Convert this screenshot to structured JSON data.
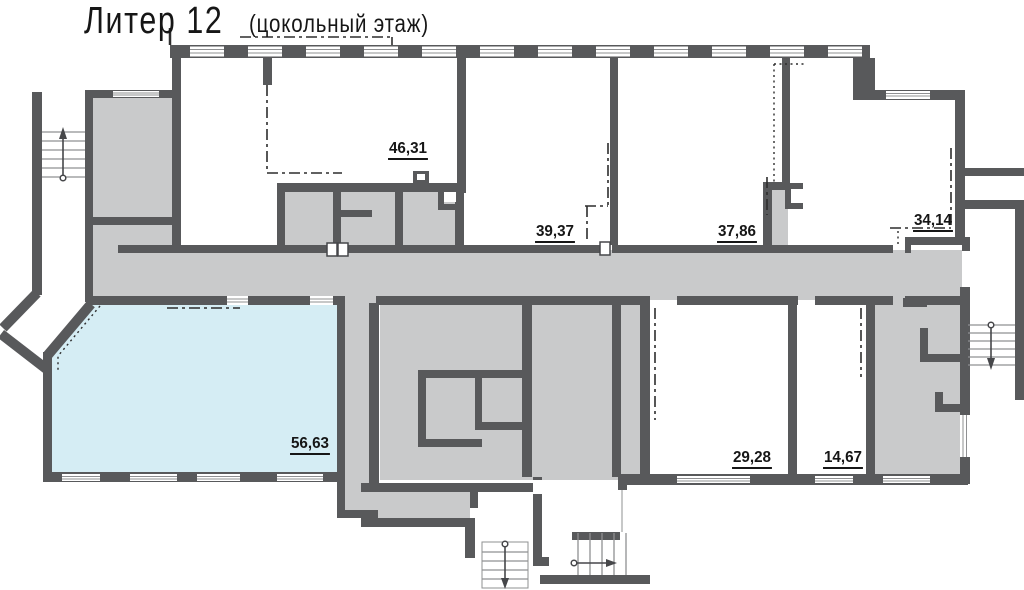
{
  "title": {
    "main": "Литер 12",
    "sub": "(цокольный этаж)"
  },
  "floor_plan": {
    "description": "Поэтажный план цокольного этажа, литер 12",
    "rooms": [
      {
        "id": "46-31",
        "area": "46,31"
      },
      {
        "id": "39-37",
        "area": "39,37"
      },
      {
        "id": "37-86",
        "area": "37,86"
      },
      {
        "id": "34-14",
        "area": "34,14"
      },
      {
        "id": "56-63",
        "area": "56,63",
        "highlighted": true
      },
      {
        "id": "29-28",
        "area": "29,28"
      },
      {
        "id": "14-67",
        "area": "14,67"
      }
    ],
    "stairs": [
      {
        "id": "exterior-left",
        "arrow": "up"
      },
      {
        "id": "exterior-right",
        "arrow": "down"
      },
      {
        "id": "interior-center",
        "arrow": "down"
      },
      {
        "id": "side-exit-center",
        "arrow": "right"
      }
    ]
  },
  "colors": {
    "wall": "#58595b",
    "common_area": "#c9cacb",
    "room": "#ffffff",
    "highlight": "#d5edf4",
    "boundary_dash": "#2d2d2d",
    "stair_line": "#8f9092",
    "arrow": "#46474a",
    "text": "#161616"
  }
}
